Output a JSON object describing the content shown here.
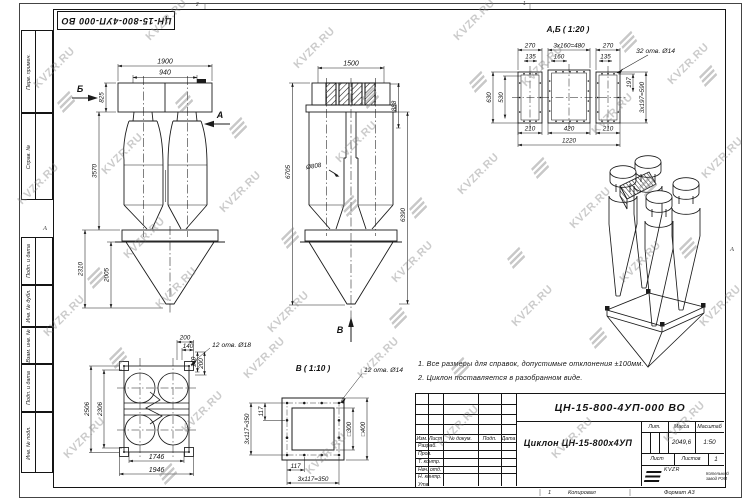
{
  "watermark": {
    "text": "KVZR.RU"
  },
  "margins": {
    "doc_number_rotated": "ЦН-15-800-4УП-000 ВО",
    "stamp_labels": [
      "Перв. примен.",
      "Справ. №",
      "Подп. и дата",
      "Инв. № дубл.",
      "Взам. инв. №",
      "Подп. и дата",
      "Инв. № подл."
    ],
    "zone_left": "А",
    "zone_right": "А",
    "zone_top_1": "2",
    "zone_top_2": "1",
    "footer_sheet_num": "1",
    "footer_copied": "Копировал",
    "footer_format": "Формат А3"
  },
  "notes": {
    "line1": "1. Все размеры для справок, допустимые отклонения ±100мм.",
    "line2": "2. Циклон поставляется в разобранном виде."
  },
  "views": {
    "front": {
      "dim_width": "1900",
      "dim_inlet": "940",
      "dim_top": "825",
      "dim_body": "3570",
      "dim_hopper": "2310",
      "dim_cone": "2005",
      "arrow_a": "А",
      "arrow_b": "Б"
    },
    "side": {
      "dim_width": "1500",
      "dim_top": "888",
      "dim_dia": "Ø808",
      "dim_total": "6705",
      "dim_inner": "6390",
      "arrow_v": "В"
    },
    "flange_ab": {
      "title": "А,Б ( 1:20 )",
      "holes": "32 отв. Ø14",
      "dim_w1": "270",
      "dim_w2": "3х160=480",
      "dim_w3": "270",
      "dim_s1": "135",
      "dim_s2": "160",
      "dim_s3": "135",
      "dim_h1": "630",
      "dim_h2": "530",
      "dim_p1": "197",
      "dim_p2": "3х197=590",
      "dim_b1": "210",
      "dim_b2": "420",
      "dim_b3": "210",
      "dim_total": "1220"
    },
    "plan": {
      "holes": "12 отв. Ø18",
      "dim_t1": "200",
      "dim_t2": "140",
      "dim_r1": "140",
      "dim_r2": "200",
      "dim_h1": "2506",
      "dim_h2": "2306",
      "dim_w1": "1746",
      "dim_w2": "1946"
    },
    "flange_b": {
      "title": "В ( 1:10 )",
      "holes": "12 отв. Ø14",
      "dim_step": "117",
      "dim_total": "3х117=350",
      "dim_sq_inner": "□300",
      "dim_sq_outer": "□400"
    }
  },
  "title_block": {
    "doc_number": "ЦН-15-800-4УП-000 ВО",
    "product_name": "Циклон ЦН-15-800х4УП",
    "col_izm": "Изм.",
    "col_list": "Лист",
    "col_doc": "№ докум.",
    "col_sign": "Подп.",
    "col_date": "Дата",
    "rows": [
      "Разраб.",
      "Пров.",
      "Т. контр.",
      "Нач. отд.",
      "Н. контр.",
      "Утв."
    ],
    "lit_label": "Лит.",
    "mass_label": "Масса",
    "scale_label": "Масштаб",
    "mass_value": "2049,6",
    "scale_value": "1:50",
    "sheet_label": "Лист",
    "sheets_label": "Листов",
    "sheets_value": "1",
    "logo_text": "KVZR",
    "logo_caption1": "Котельный",
    "logo_caption2": "завод РЭП"
  }
}
